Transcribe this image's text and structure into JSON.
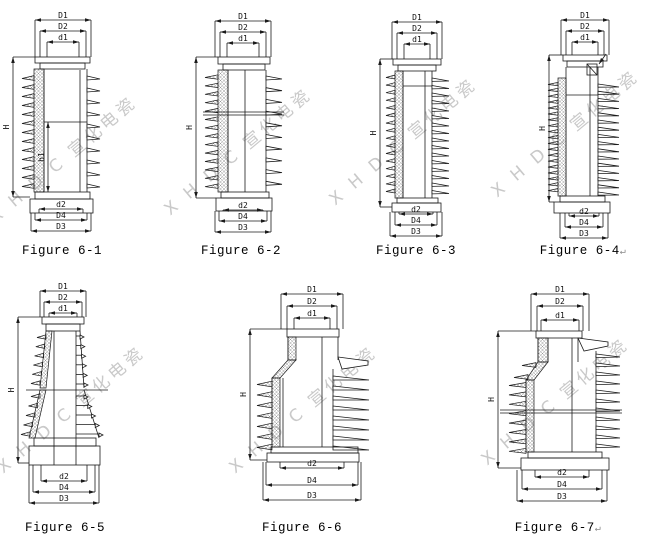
{
  "colors": {
    "line": "#1a1a1a",
    "watermark": "#c0c0c0",
    "background": "#ffffff"
  },
  "watermark": {
    "text": "X H D C 宣化电瓷"
  },
  "figures": [
    {
      "id": "6-1",
      "caption": "Figure 6-1",
      "suffix": "",
      "top_dims": [
        "D1",
        "D2",
        "d1"
      ],
      "height_dim": "H",
      "inner_height_dim": "h1",
      "bottom_dims": [
        "d2",
        "D4",
        "D3"
      ]
    },
    {
      "id": "6-2",
      "caption": "Figure 6-2",
      "suffix": "",
      "top_dims": [
        "D1",
        "D2",
        "d1"
      ],
      "height_dim": "H",
      "bottom_dims": [
        "d2",
        "D4",
        "D3"
      ]
    },
    {
      "id": "6-3",
      "caption": "Figure 6-3",
      "suffix": "",
      "top_dims": [
        "D1",
        "D2",
        "d1"
      ],
      "height_dim": "H",
      "bottom_dims": [
        "d2",
        "D4",
        "D3"
      ]
    },
    {
      "id": "6-4",
      "caption": "Figure 6-4",
      "suffix": "↵",
      "top_dims": [
        "D1",
        "D2",
        "d1"
      ],
      "height_dim": "H",
      "bottom_dims": [
        "d2",
        "D4",
        "D3"
      ]
    },
    {
      "id": "6-5",
      "caption": "Figure 6-5",
      "suffix": "",
      "top_dims": [
        "D1",
        "D2",
        "d1"
      ],
      "height_dim": "H",
      "bottom_dims": [
        "d2",
        "D4",
        "D3"
      ]
    },
    {
      "id": "6-6",
      "caption": "Figure 6-6",
      "suffix": "",
      "top_dims": [
        "D1",
        "D2",
        "d1"
      ],
      "height_dim": "H",
      "bottom_dims": [
        "d2",
        "D4",
        "D3"
      ]
    },
    {
      "id": "6-7",
      "caption": "Figure 6-7",
      "suffix": "↵",
      "top_dims": [
        "D1",
        "D2",
        "d1"
      ],
      "height_dim": "H",
      "bottom_dims": [
        "d2",
        "D4",
        "D3"
      ]
    }
  ]
}
